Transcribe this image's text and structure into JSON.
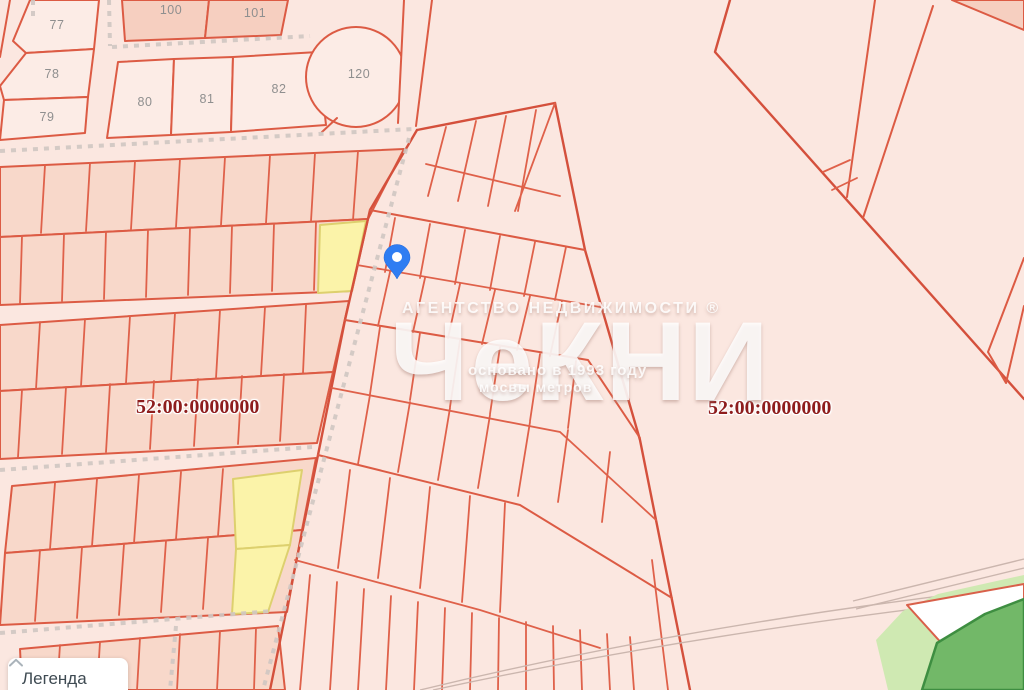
{
  "map": {
    "background_color": "#fbe7e0",
    "parcel_line_color": "#dc5b44",
    "strip_fill_color": "#f8d8ca",
    "block_fill_color": "#f6cfc0",
    "highlight_yellow_color": "#fbf3a9",
    "green_area_color": "#cfe9b2",
    "green_parcel_fill_color": "#72b868",
    "green_parcel_border_color": "#3e8e41",
    "pin_color": "#2f7df2",
    "parcel_numbers": [
      {
        "text": "77"
      },
      {
        "text": "78"
      },
      {
        "text": "79"
      },
      {
        "text": "80"
      },
      {
        "text": "81"
      },
      {
        "text": "82"
      },
      {
        "text": "100"
      },
      {
        "text": "101"
      },
      {
        "text": "120"
      }
    ],
    "cadastral_labels": [
      {
        "text": "52:00:0000000"
      },
      {
        "text": "52:00:0000000"
      }
    ],
    "watermark": {
      "agency_line": "АГЕНТСТВО НЕДВИЖИМОСТИ ®",
      "brand": "ЧеКНИ",
      "founded_line": "основано в 1993 году",
      "tagline": "мосвы метров"
    }
  },
  "legend": {
    "label": "Легенда"
  }
}
